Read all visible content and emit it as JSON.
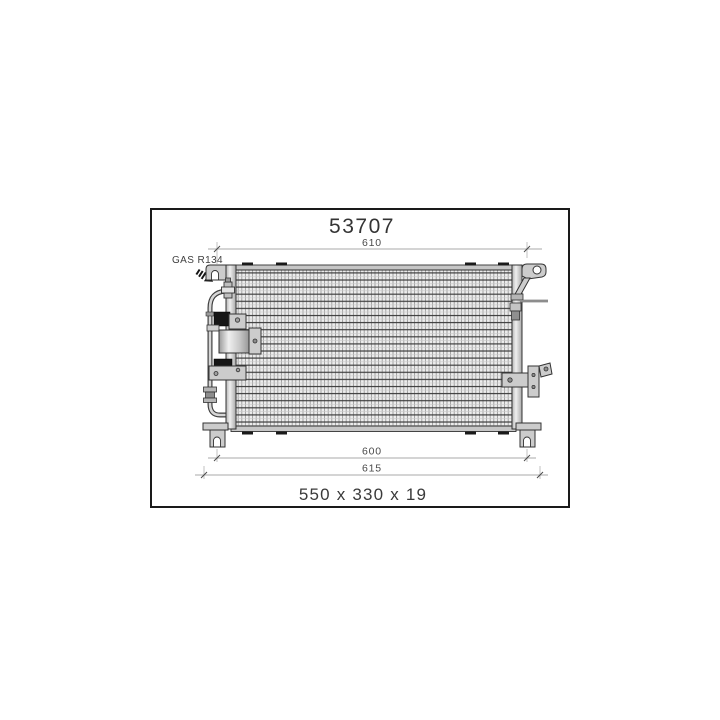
{
  "diagram": {
    "part_number": "53707",
    "gas_type_label": "GAS R134",
    "dimensions": {
      "top_width": "610",
      "mounting_width": "600",
      "overall_width": "615",
      "overall_size": "550 x 330 x 19"
    }
  },
  "colors": {
    "background": "#ffffff",
    "frame_border": "#1a1a1a",
    "drawing_line": "#333333",
    "fill_light": "#cccccc",
    "fill_black": "#161616",
    "dimension_line": "#8c8c8c",
    "text": "#3b3b3b"
  }
}
